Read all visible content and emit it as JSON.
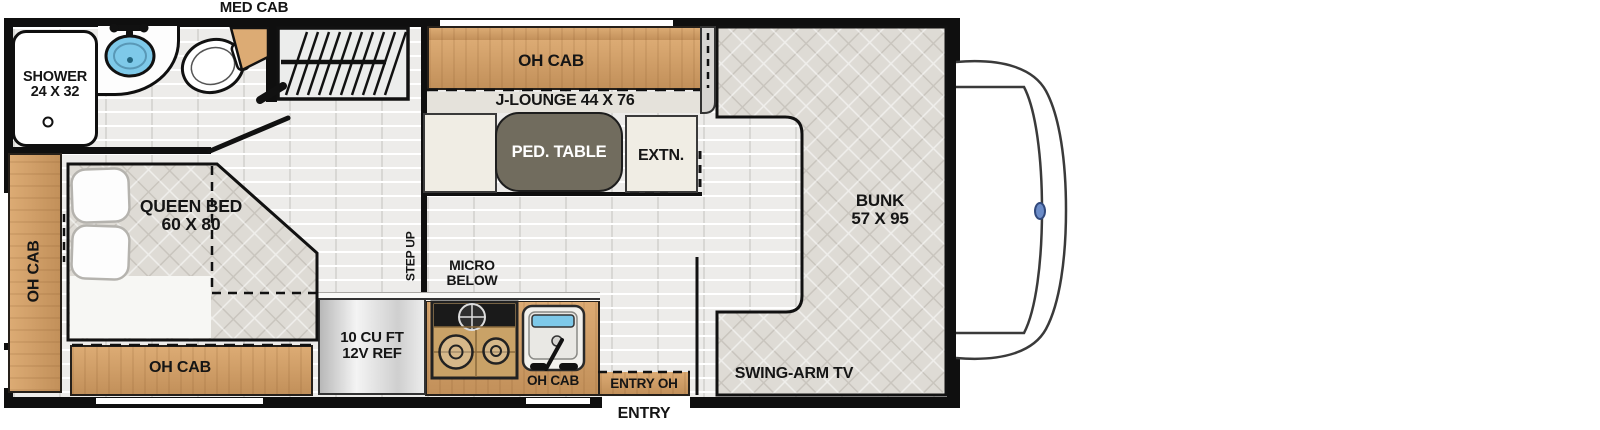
{
  "floorplan": {
    "labels": {
      "med_cab": "MED CAB",
      "shower_line1": "SHOWER",
      "shower_line2": "24 X 32",
      "oh_cab": "OH CAB",
      "j_lounge": "J-LOUNGE 44 X 76",
      "ped_table": "PED. TABLE",
      "extn": "EXTN.",
      "bunk_line1": "BUNK",
      "bunk_line2": "57 X 95",
      "queen_line1": "QUEEN BED",
      "queen_line2": "60 X 80",
      "step_up": "STEP UP",
      "micro_line1": "MICRO",
      "micro_line2": "BELOW",
      "ref_line1": "10 CU FT",
      "ref_line2": "12V REF",
      "entry_oh": "ENTRY OH",
      "entry": "ENTRY",
      "swing_arm_tv": "SWING-ARM TV"
    },
    "fixtures": [
      "shower",
      "bathroom-sink",
      "toilet",
      "medicine-cabinet",
      "wardrobe",
      "j-lounge",
      "pedestal-table",
      "bunk-over-cab",
      "queen-bed",
      "refrigerator",
      "cooktop",
      "kitchen-sink",
      "entry-door",
      "swing-arm-tv",
      "cab-front"
    ],
    "colors": {
      "border": "#0f0f0f",
      "wood": "#dcab74",
      "wood_dark": "#c2905a",
      "floor": "#edecea",
      "quilt": "#dedbd5",
      "quilt_line": "#c9c5be",
      "bench": "#f0ede4",
      "table": "#716c5e",
      "sink_blue": "#7ec9e9",
      "wall_gray": "#d7d5d2",
      "emblem": "#6b8cc8",
      "text": "#151515"
    }
  }
}
